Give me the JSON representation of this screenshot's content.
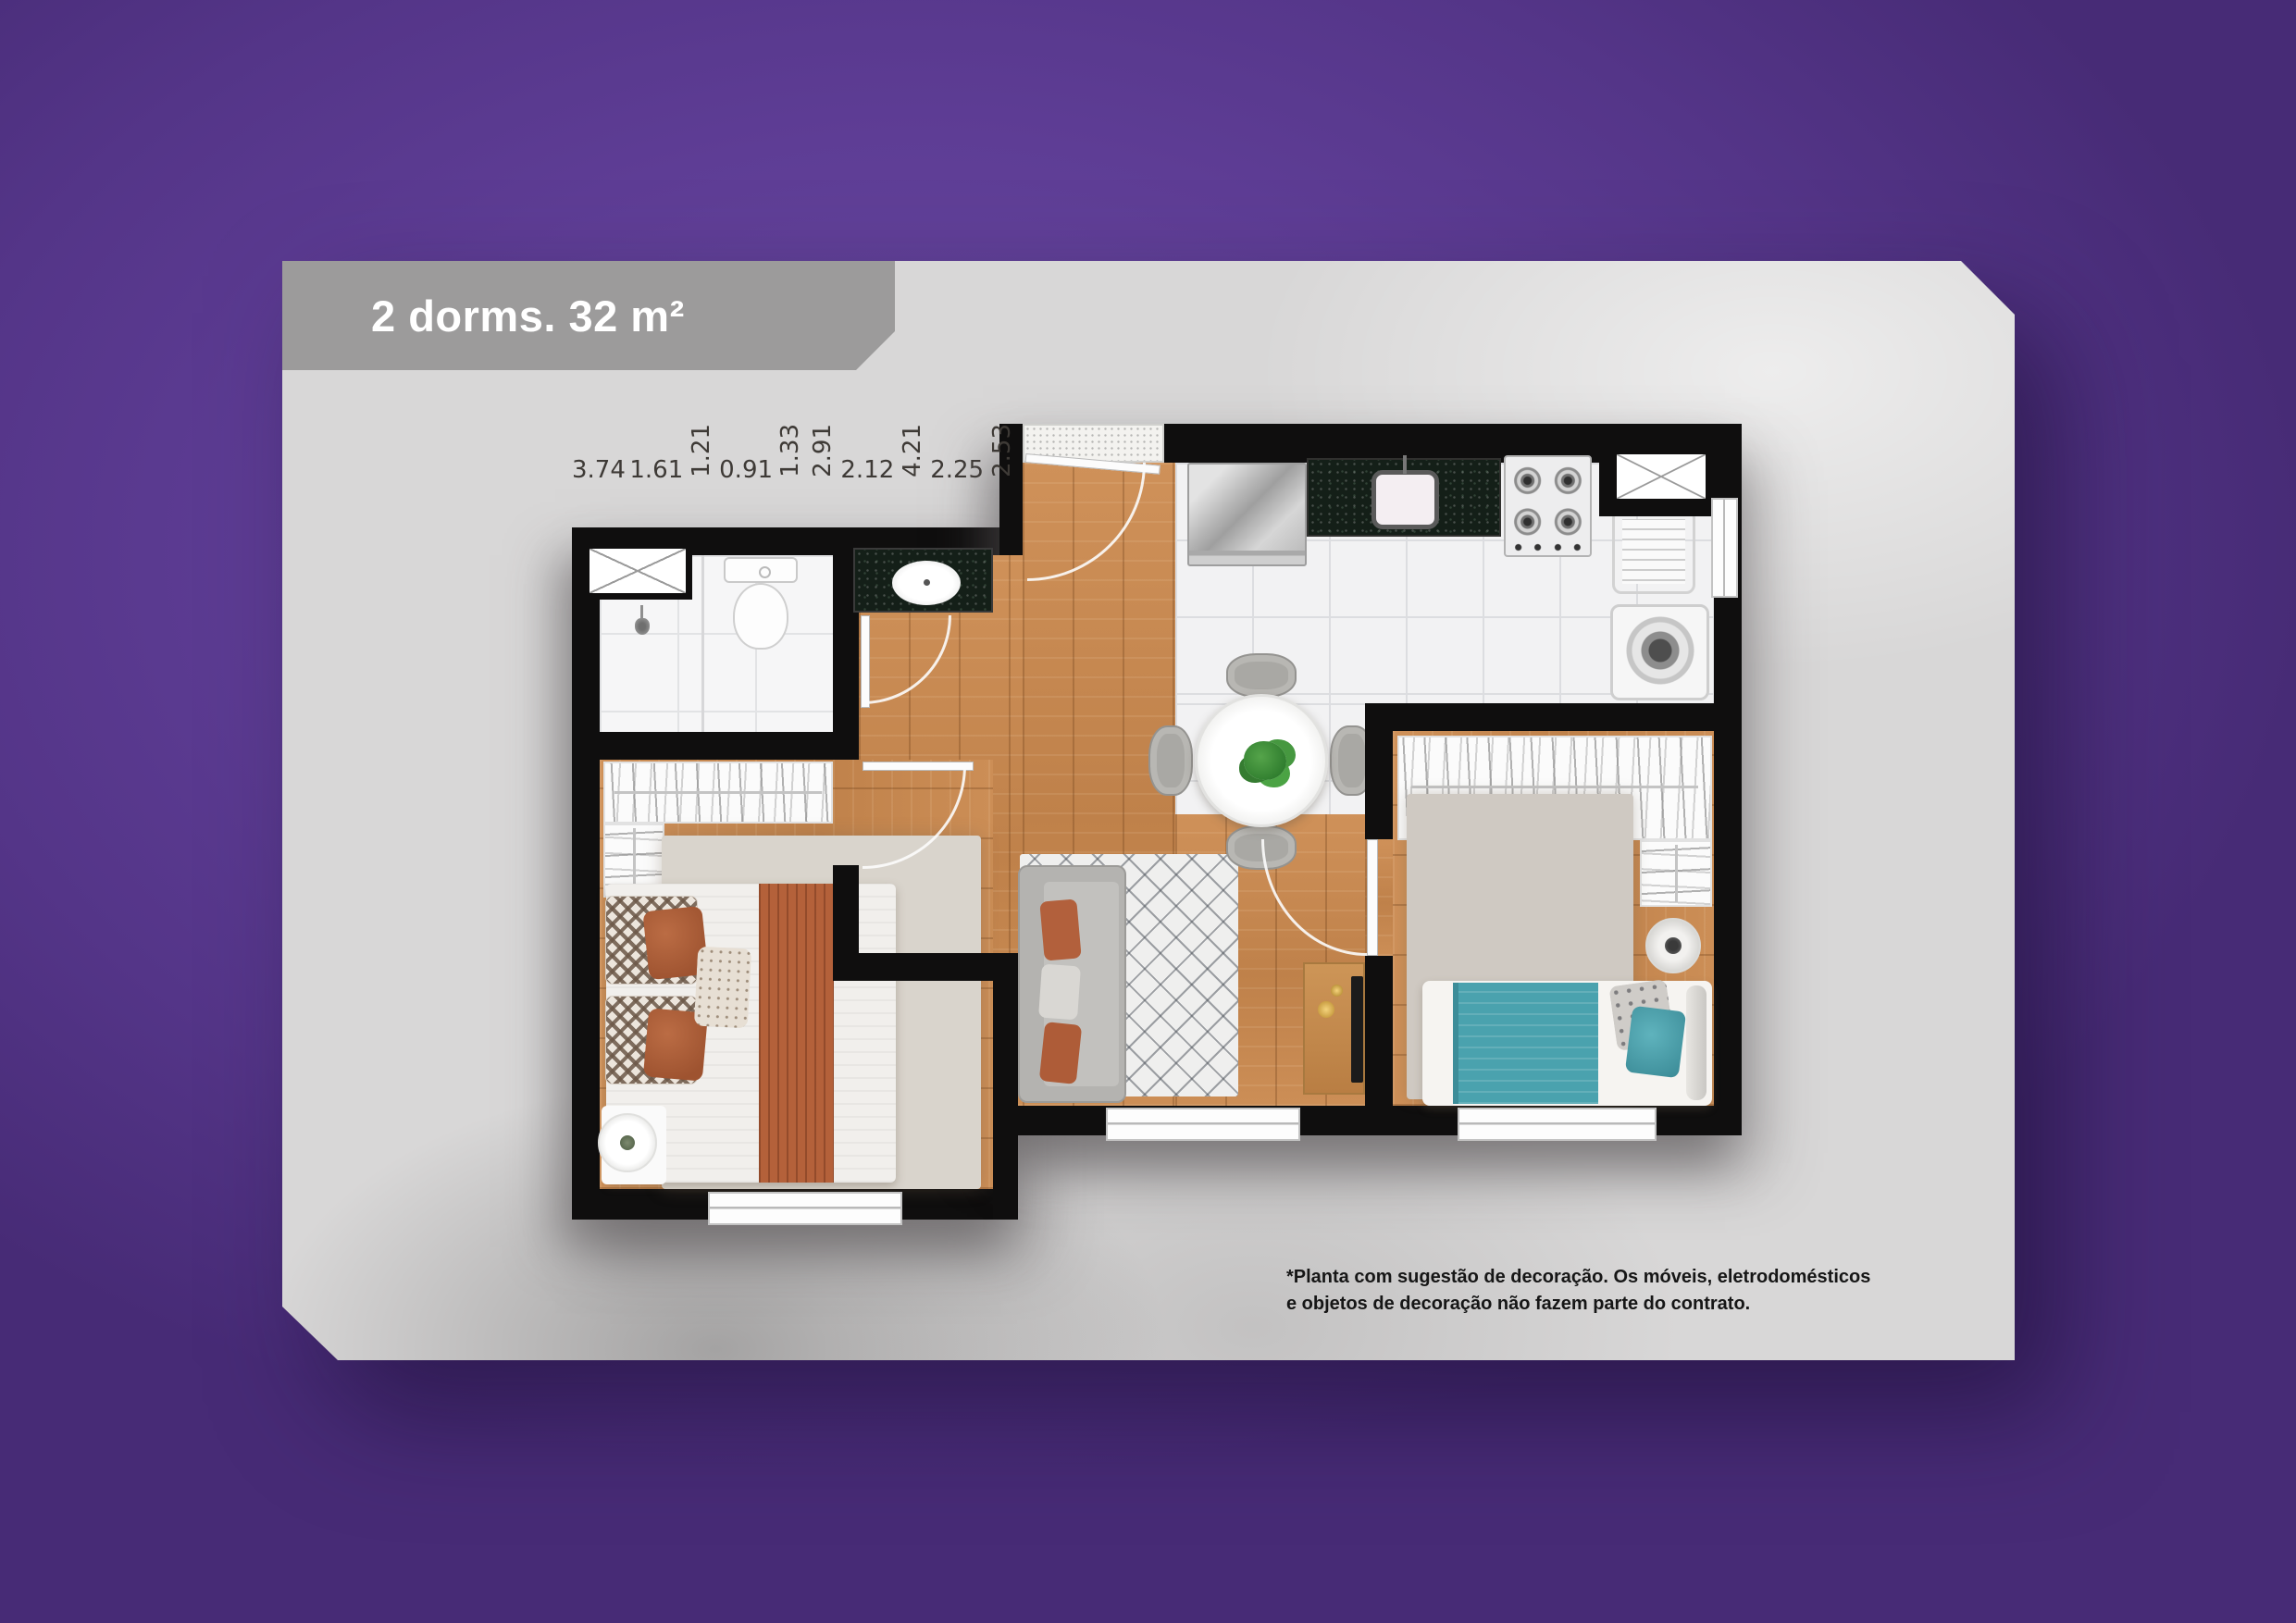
{
  "title_banner": {
    "label": "2 dorms. 32 m²"
  },
  "disclaimer": {
    "line1": "*Planta com sugestão de decoração. Os móveis, eletrodomésticos",
    "line2": "e objetos de decoração não fazem parte do contrato."
  },
  "floor_plan": {
    "measurements": [
      {
        "name": "hall-entry-width",
        "value": "3.74",
        "rotated": false
      },
      {
        "name": "shower-width",
        "value": "1.61",
        "rotated": false
      },
      {
        "name": "bathroom-width",
        "value": "1.21",
        "rotated": true
      },
      {
        "name": "vanity-width",
        "value": "0.91",
        "rotated": false
      },
      {
        "name": "laundry-width",
        "value": "1.33",
        "rotated": true
      },
      {
        "name": "hallway-length",
        "value": "2.91",
        "rotated": true
      },
      {
        "name": "bedroom2-closet-width",
        "value": "2.12",
        "rotated": false
      },
      {
        "name": "living-length",
        "value": "4.21",
        "rotated": true
      },
      {
        "name": "living-width",
        "value": "2.25",
        "rotated": false
      },
      {
        "name": "bedroom2-length",
        "value": "2.53",
        "rotated": true
      },
      {
        "name": "bedroom1-width",
        "value": "2.61",
        "rotated": false
      }
    ]
  },
  "colors": {
    "background_purple": "#5e3d95",
    "card_gray": "#d8d7d7",
    "banner_gray": "#9c9b9b",
    "title_white": "#ffffff",
    "wall_black": "#0f0e0e",
    "wood_floor": "#c98c55",
    "tile_white": "#f2f2f3",
    "granite_black": "#141f18",
    "accent_terracotta": "#b2603c",
    "accent_teal": "#4aa2ae",
    "disclaimer_text": "#161616",
    "dimension_text": "#3e3a36"
  }
}
